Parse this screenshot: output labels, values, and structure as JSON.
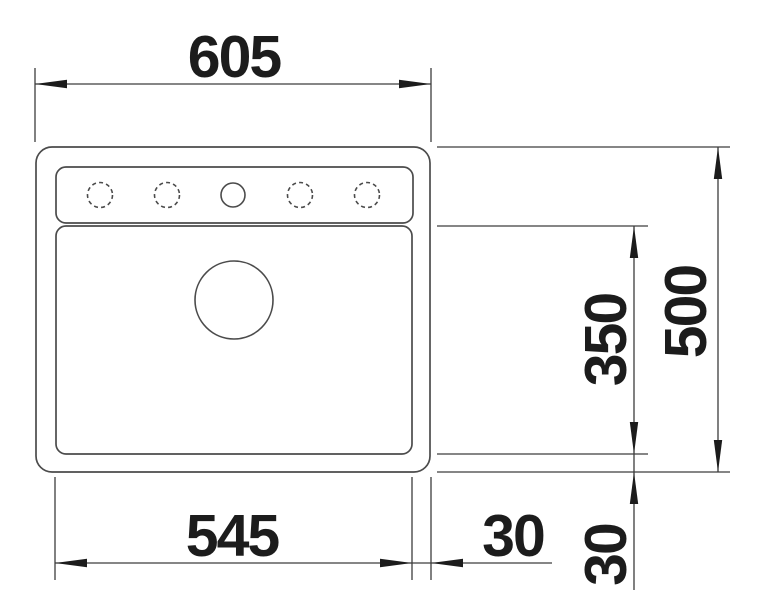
{
  "drawing": {
    "title": "sink-top-view-dimension-drawing",
    "dimensions": {
      "overall_width": "605",
      "overall_depth": "500",
      "cutout_width": "545",
      "bowl_depth": "350",
      "edge_offset_right": "30",
      "edge_offset_bottom": "30"
    },
    "colors": {
      "line": "#4b4b4b",
      "dimension_line": "#3d3d3d",
      "text": "#1c1c1c",
      "background": "#ffffff"
    }
  }
}
